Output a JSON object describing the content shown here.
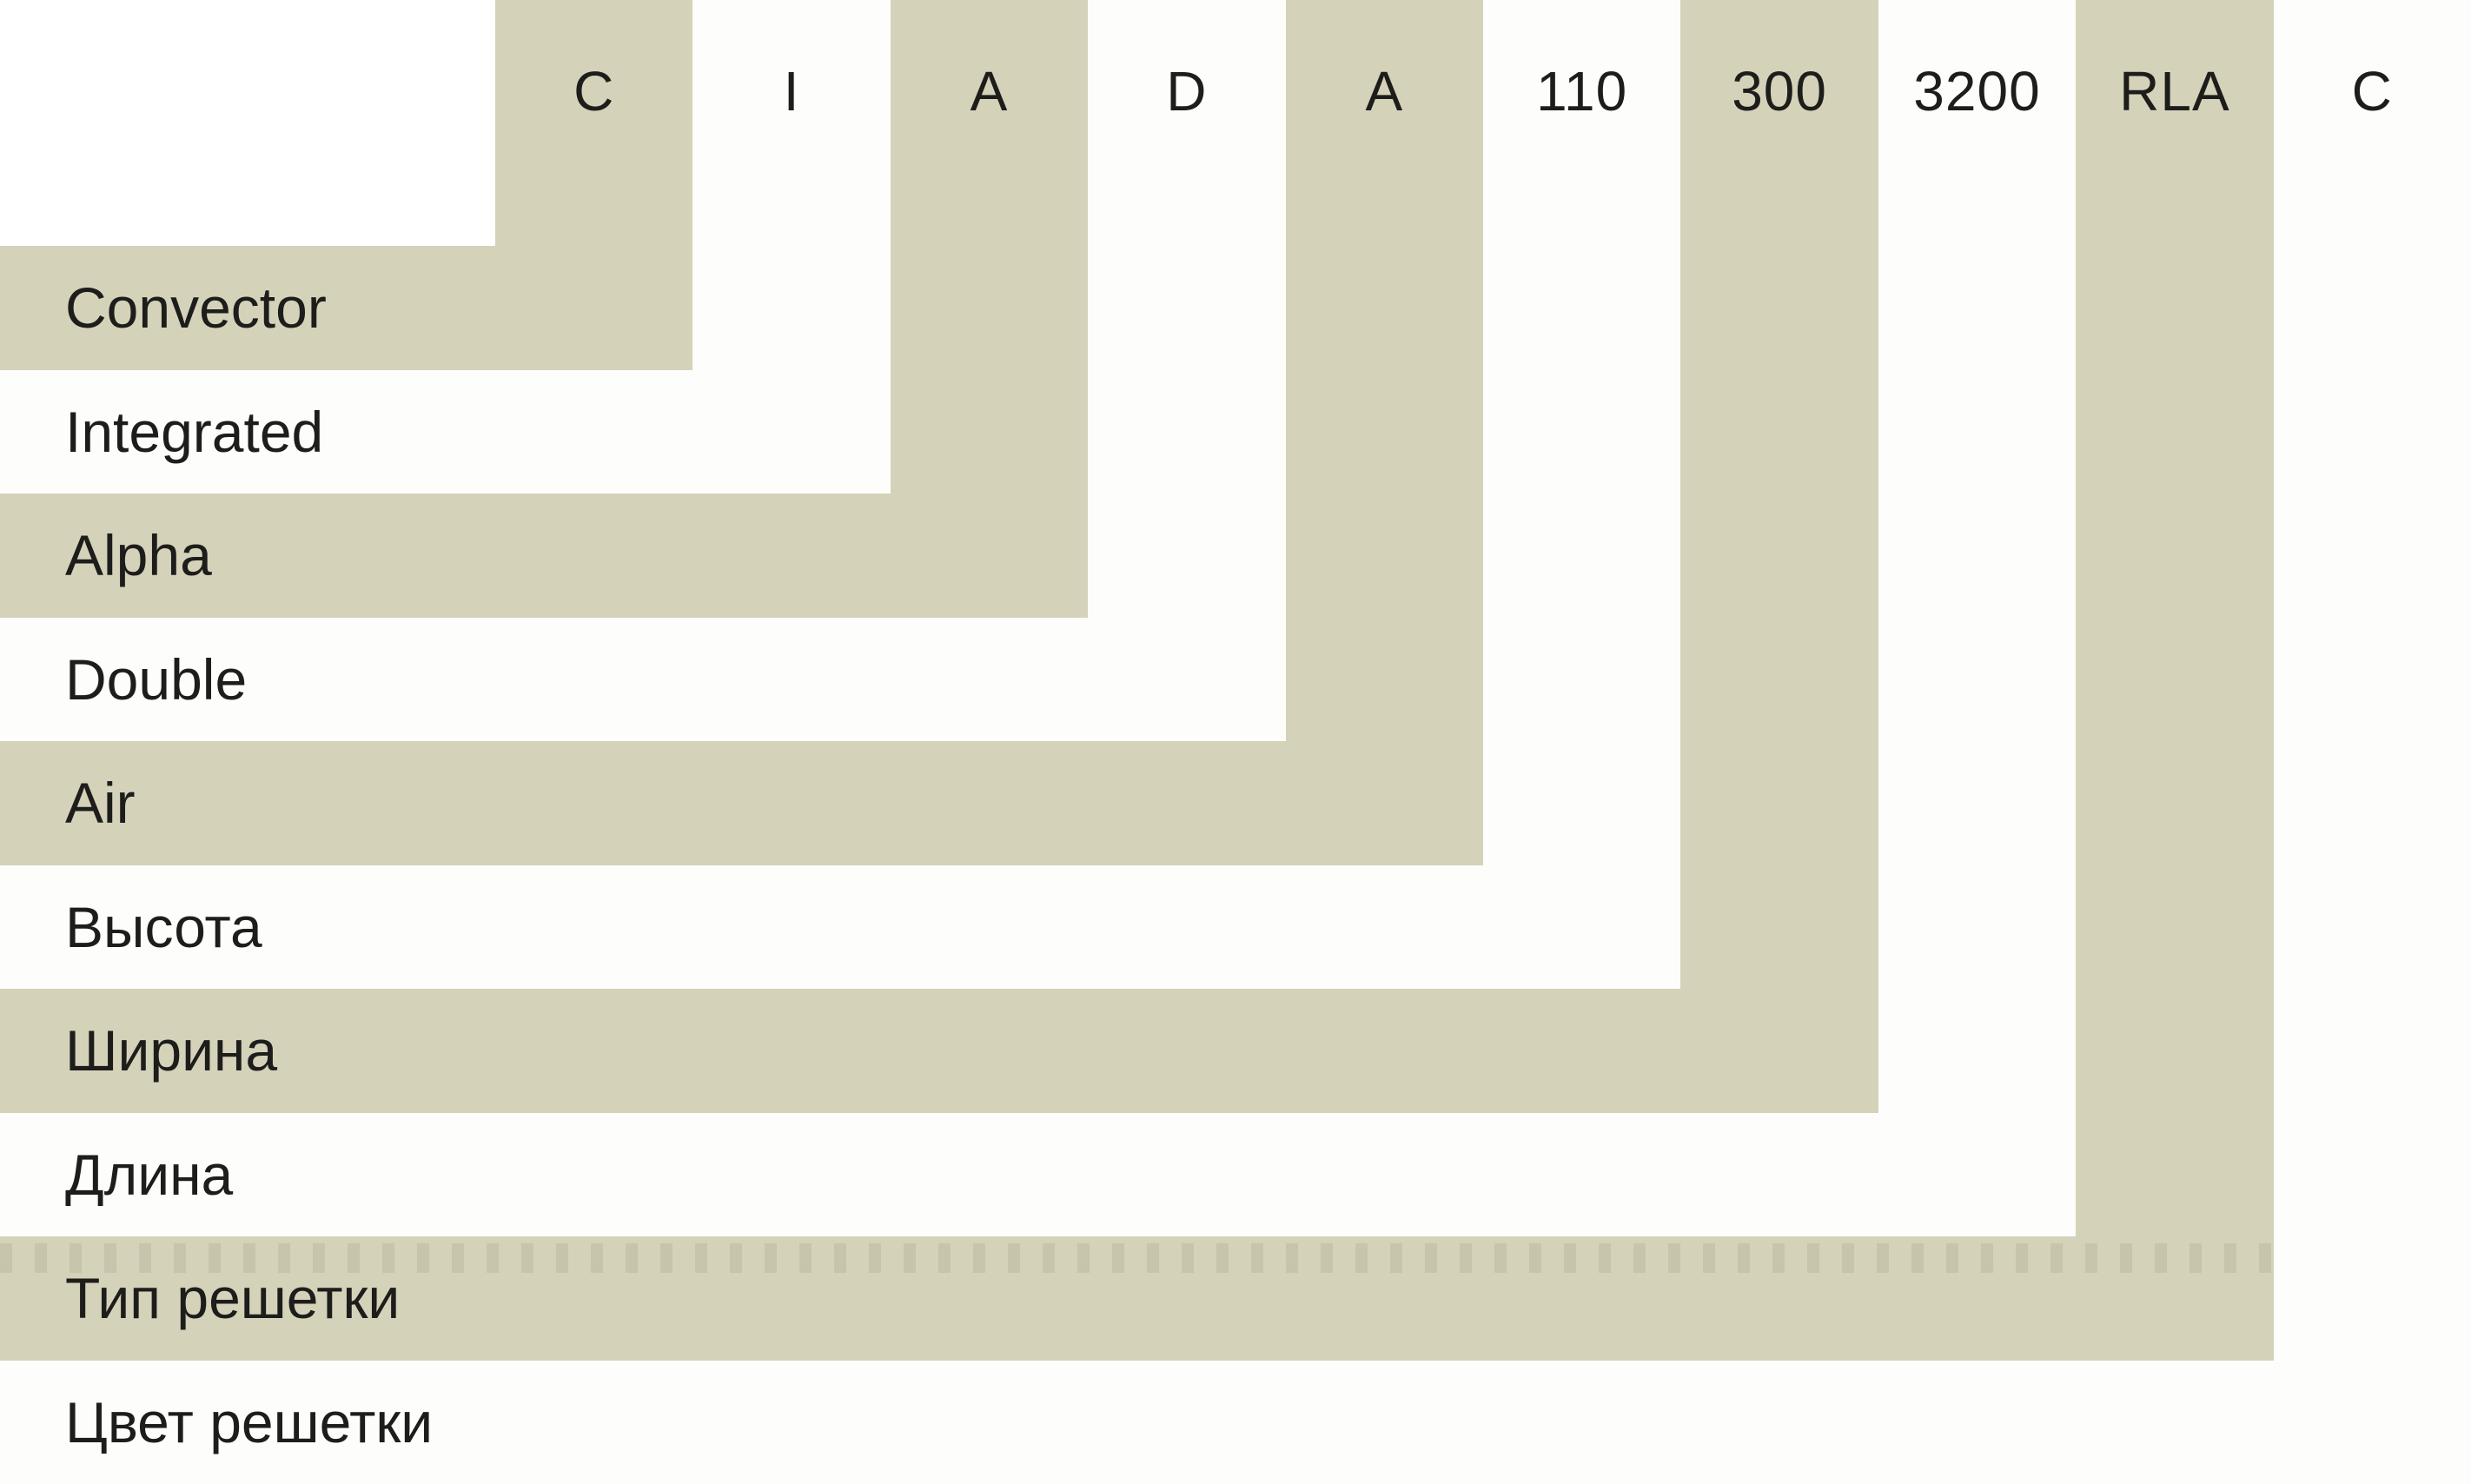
{
  "diagram": {
    "items": [
      {
        "code": "C",
        "label": "Convector"
      },
      {
        "code": "I",
        "label": "Integrated"
      },
      {
        "code": "A",
        "label": "Alpha"
      },
      {
        "code": "D",
        "label": "Double"
      },
      {
        "code": "A",
        "label": "Air"
      },
      {
        "code": "110",
        "label": "Высота"
      },
      {
        "code": "300",
        "label": "Ширина"
      },
      {
        "code": "3200",
        "label": "Длина"
      },
      {
        "code": "RLA",
        "label": "Тип решетки"
      },
      {
        "code": "C",
        "label": "Цвет решетки"
      }
    ],
    "colors": {
      "band_beige": "#d5d2ba",
      "band_white": "#fdfdfb",
      "text": "#1d1d1b",
      "background": "#ffffff"
    }
  }
}
